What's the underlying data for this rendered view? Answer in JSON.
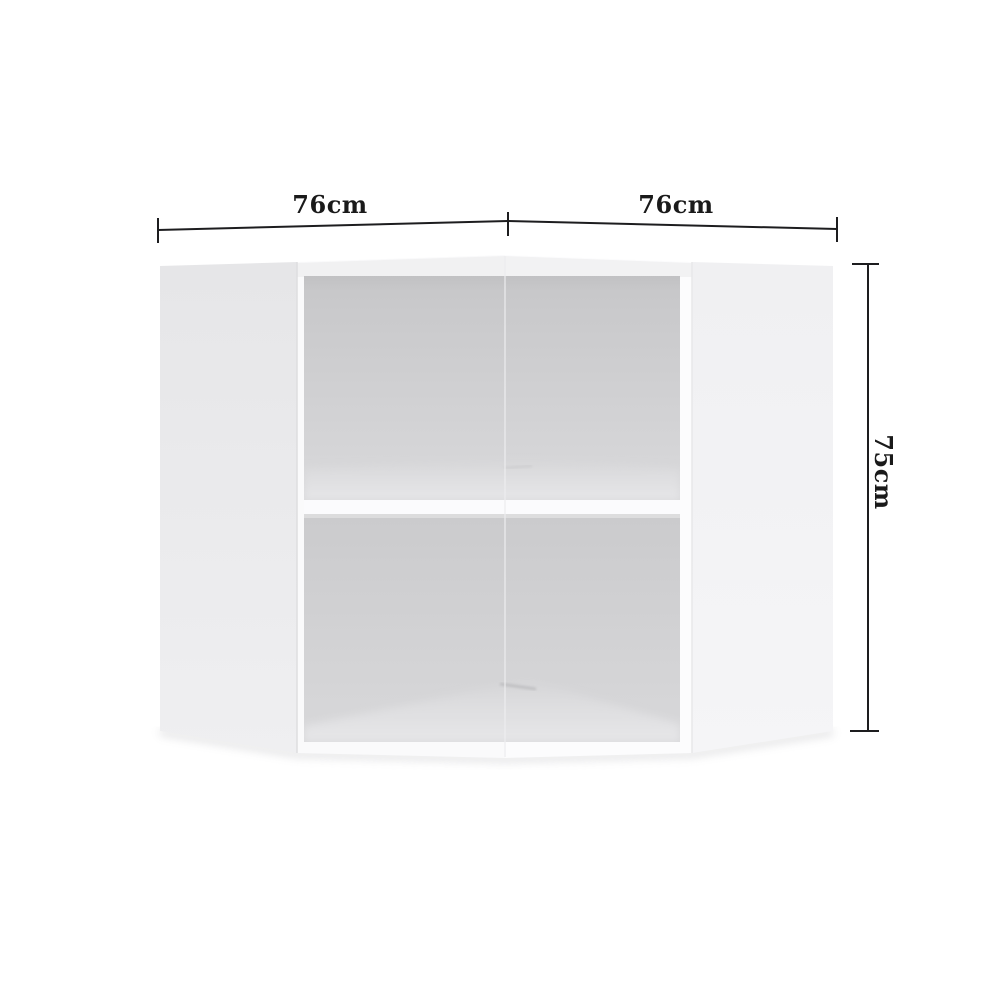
{
  "diagram": {
    "kind": "product-dimension-diagram",
    "subject": "corner wall cabinet with two open shelf compartments",
    "labels": {
      "width_left": "76cm",
      "width_right": "76cm",
      "height": "75cm"
    },
    "colors": {
      "background": "#ffffff",
      "dimension_line": "#1d1d1f",
      "dimension_text": "#1a1a1a",
      "cabinet_front": "#fafafb",
      "side_panel_left": "#e7e7e9",
      "side_panel_right": "#f2f2f4",
      "interior_top": "#c6c6c8",
      "interior_bottom": "#dadadc",
      "shelf": "#fbfbfd"
    }
  }
}
